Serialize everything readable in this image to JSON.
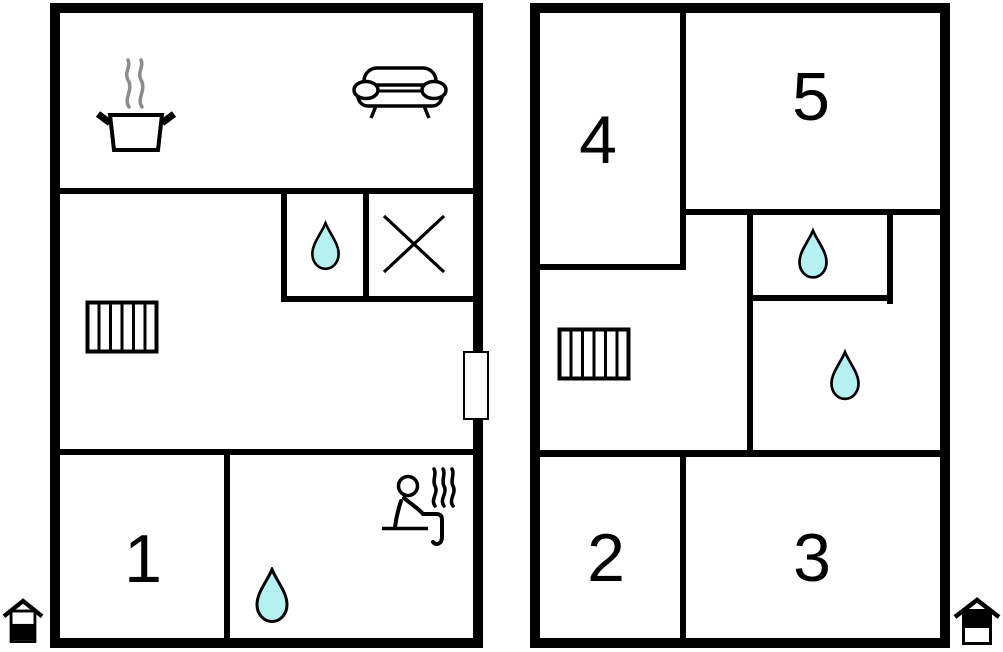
{
  "colors": {
    "wall": "#000000",
    "water": "#b6f1f2",
    "steam": "#8c8c8c",
    "line": "#000000",
    "background": "#ffffff"
  },
  "plans": {
    "left": {
      "floor_indicator_icon": "house-lower-half-filled",
      "rooms": [
        {
          "number": "1"
        }
      ],
      "icons": [
        "cooking-pot",
        "sofa",
        "water-drop",
        "crossed-area",
        "stairs",
        "door-window-marker",
        "water-drop",
        "sauna"
      ]
    },
    "right": {
      "floor_indicator_icon": "house-upper-half-filled",
      "rooms": [
        {
          "number": "2"
        },
        {
          "number": "3"
        },
        {
          "number": "4"
        },
        {
          "number": "5"
        }
      ],
      "icons": [
        "stairs",
        "water-drop",
        "water-drop"
      ]
    }
  }
}
